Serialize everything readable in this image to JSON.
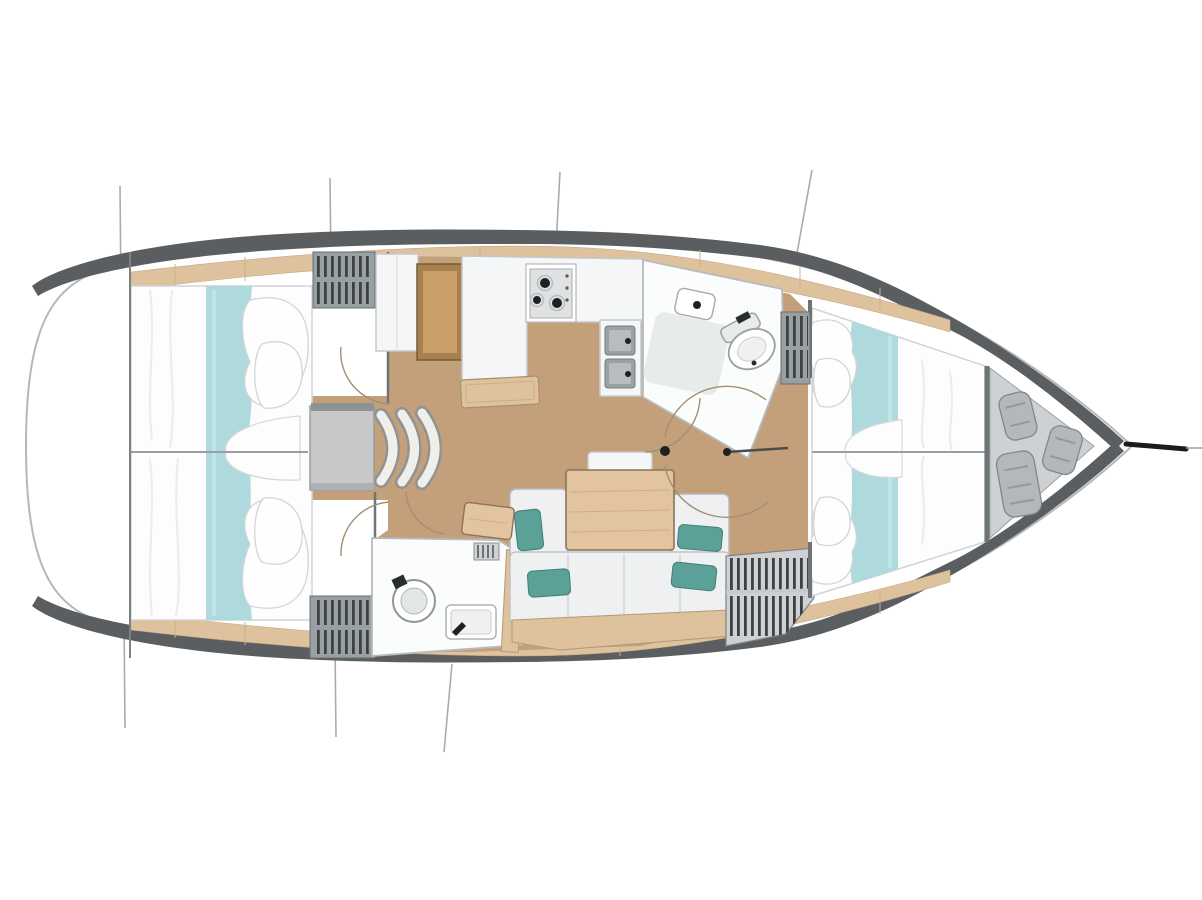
{
  "diagram": {
    "type": "sailboat-interior-floor-plan",
    "orientation": {
      "bow": "right",
      "stern": "left"
    },
    "rooms": [
      "aft-cabin-port",
      "aft-cabin-starboard",
      "companionway",
      "galley",
      "nav-chart-table",
      "forward-head",
      "aft-head",
      "saloon",
      "forward-cabin",
      "anchor-locker",
      "bow-sprit"
    ],
    "furniture": [
      "double-berth-aft-port",
      "double-berth-aft-starboard",
      "companionway-steps",
      "galley-counter",
      "stove-two-burner",
      "double-sink",
      "toilet-forward",
      "toilet-aft",
      "washbasin",
      "saloon-table",
      "settee-with-cushions",
      "stool",
      "center-bench",
      "fenders-x3",
      "louvered-lockers"
    ]
  },
  "colors": {
    "deck_white": "#ffffff",
    "hull_outline": "#b5b8ba",
    "bulwark_gray": "#5a5e60",
    "shelf_wood": "#dec29e",
    "floor_wood": "#c4a07a",
    "bed_white": "#fdfdfd",
    "bed_stroke": "#d0d4d6",
    "bed_runner_teal": "#aedade",
    "pillow_teal": "#5ba197",
    "cushion_white": "#eff0f1",
    "counter_white": "#f5f6f7",
    "table_wood": "#e2c59e",
    "chart_table_wood": "#c89e69",
    "step_gray": "#c6c8ca",
    "locker_gray": "#99a0a4",
    "locker_stripe": "#3d4144",
    "anchor_locker_gray": "#ced1d3",
    "fender_gray": "#b5b8ba",
    "fixture_dark": "#1e2022",
    "door_arc": "#a38f72",
    "bulkhead": "#6f7476",
    "rigging": "#a3a3a3"
  }
}
